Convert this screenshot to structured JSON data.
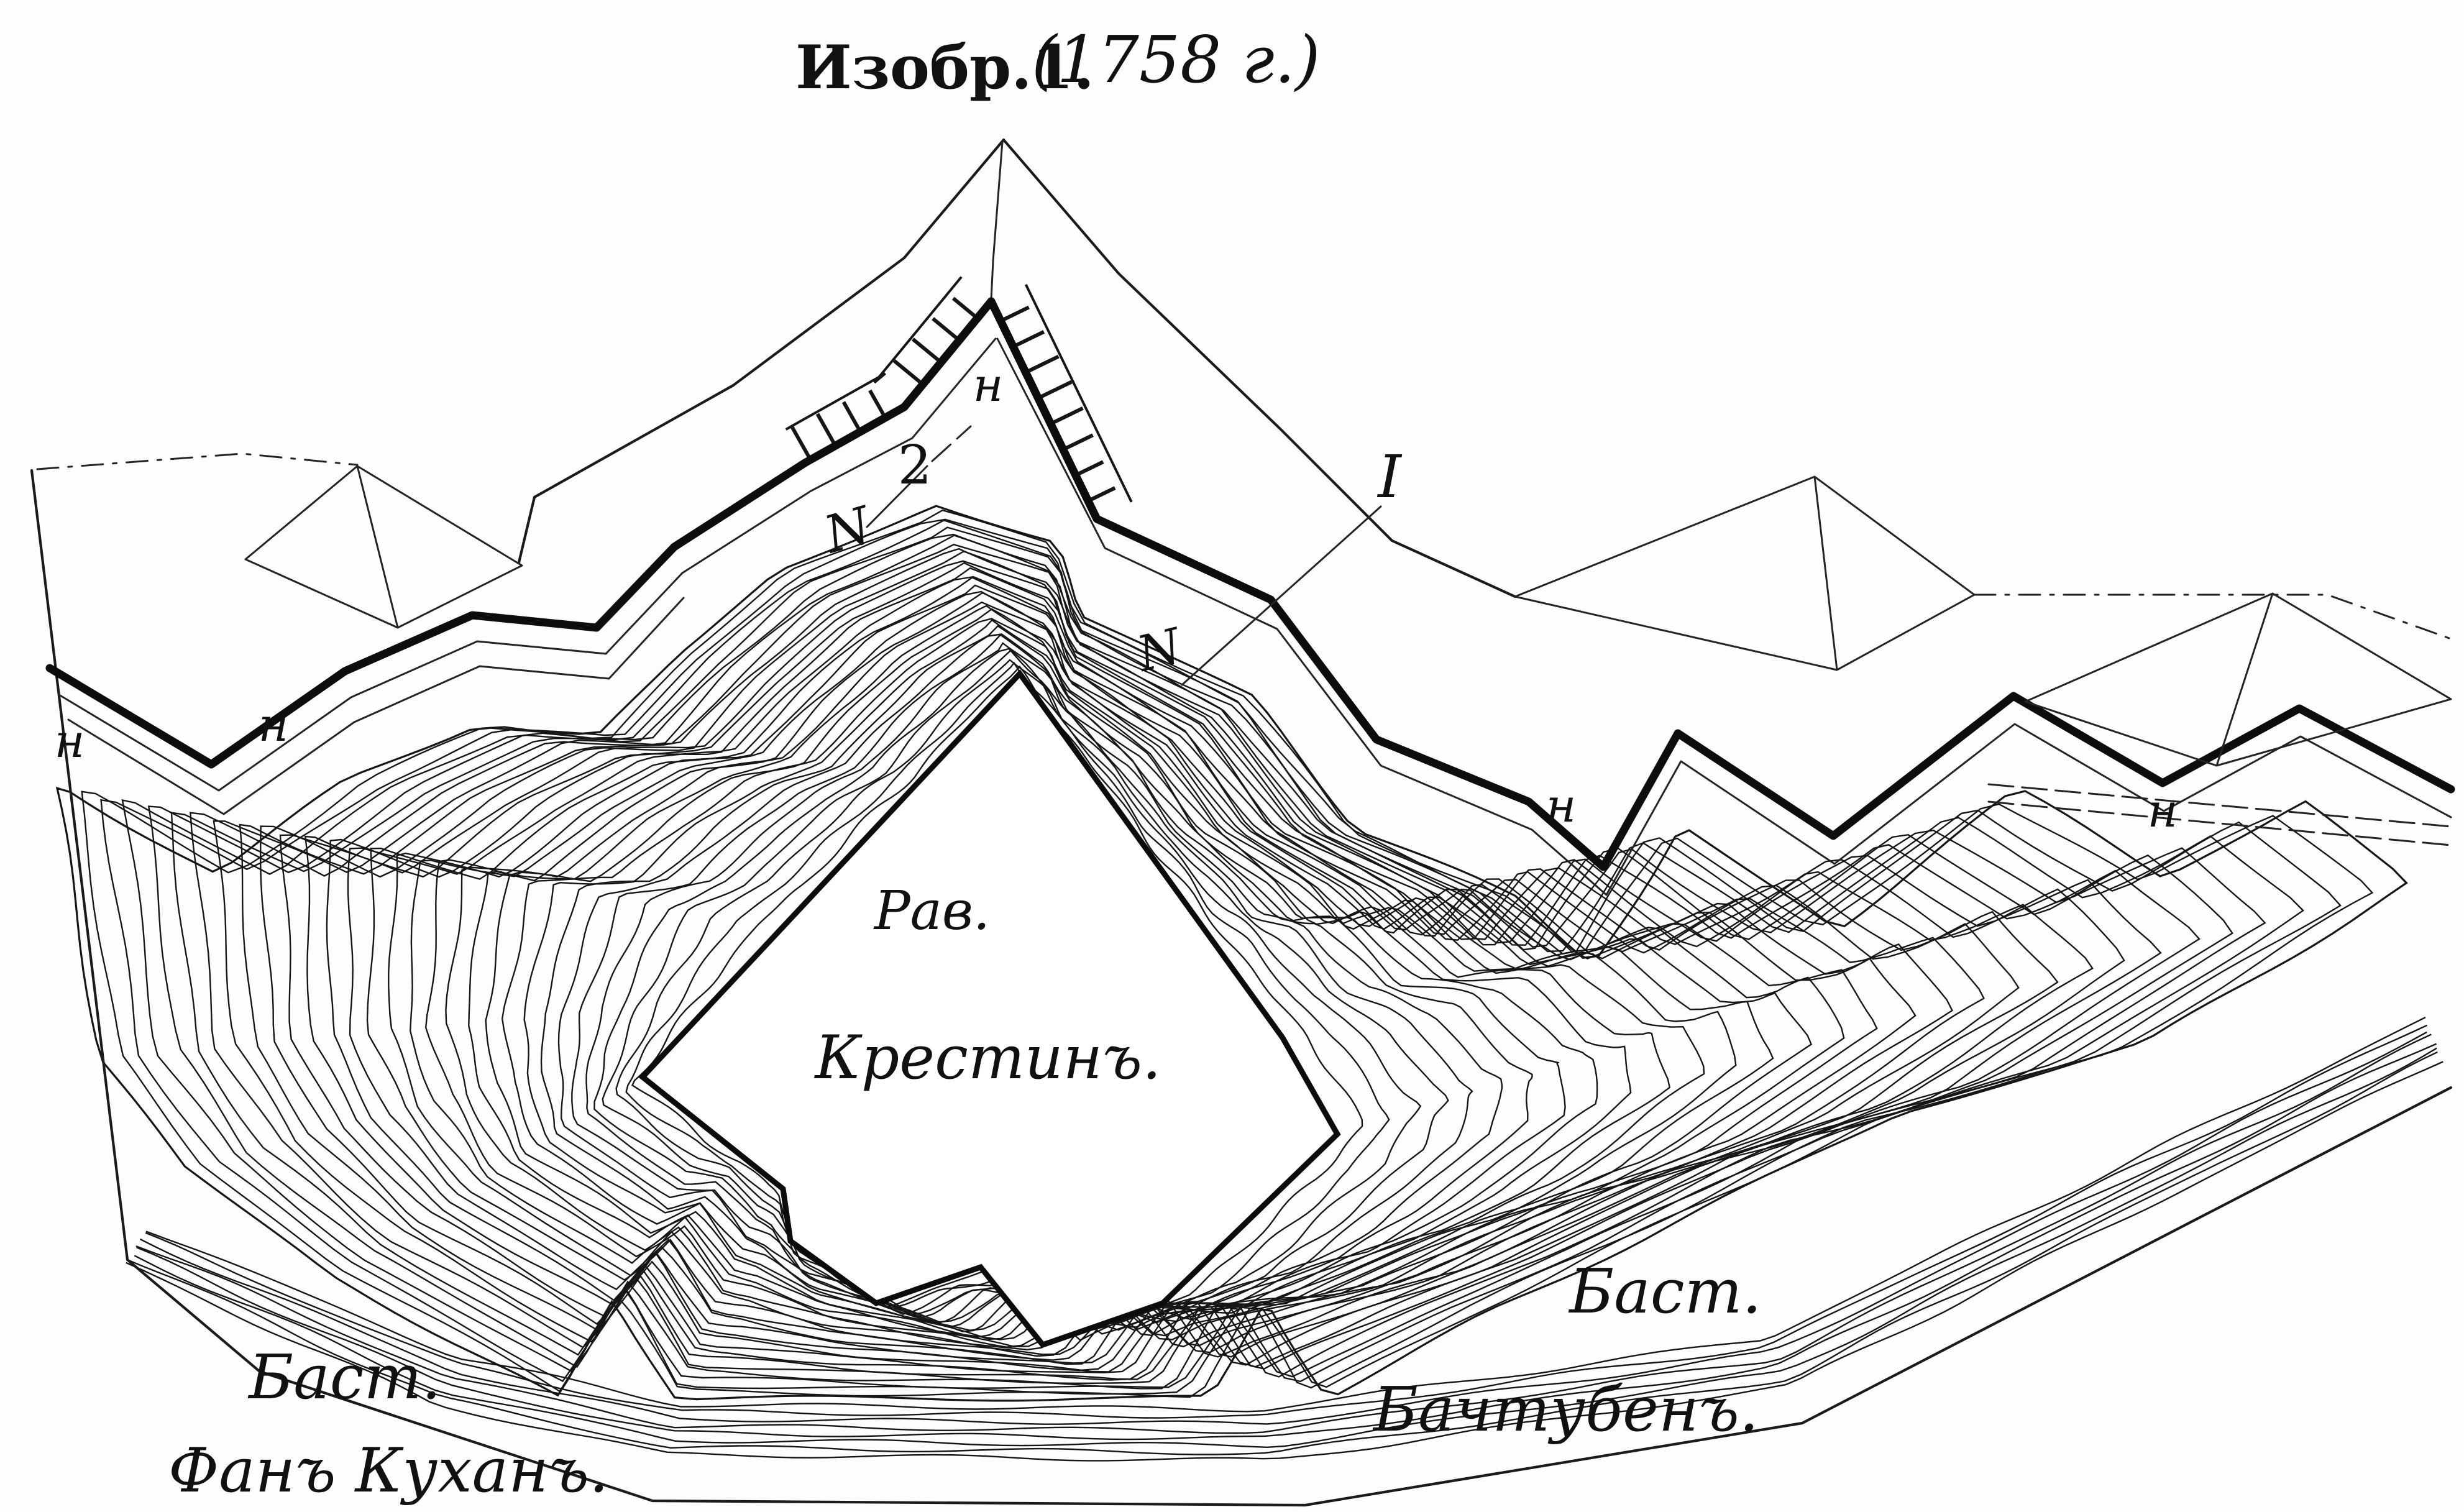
{
  "figure": {
    "title": {
      "label": "Изобр.1.",
      "year": "(1758 г.)"
    },
    "features": {
      "ravelin": {
        "abbr": "Рав.",
        "name": "Крестинъ."
      },
      "bastion_left": {
        "abbr": "Баст.",
        "name": "Фанъ Куханъ."
      },
      "bastion_right": {
        "abbr": "Баст.",
        "name": "Бачтубенъ."
      }
    },
    "marks": {
      "glacis": [
        "н",
        "н",
        "н",
        "н",
        "н"
      ],
      "number_letter": "N",
      "number_value": "2",
      "line_mark": "I",
      "counterscarp_letter": "N"
    }
  }
}
